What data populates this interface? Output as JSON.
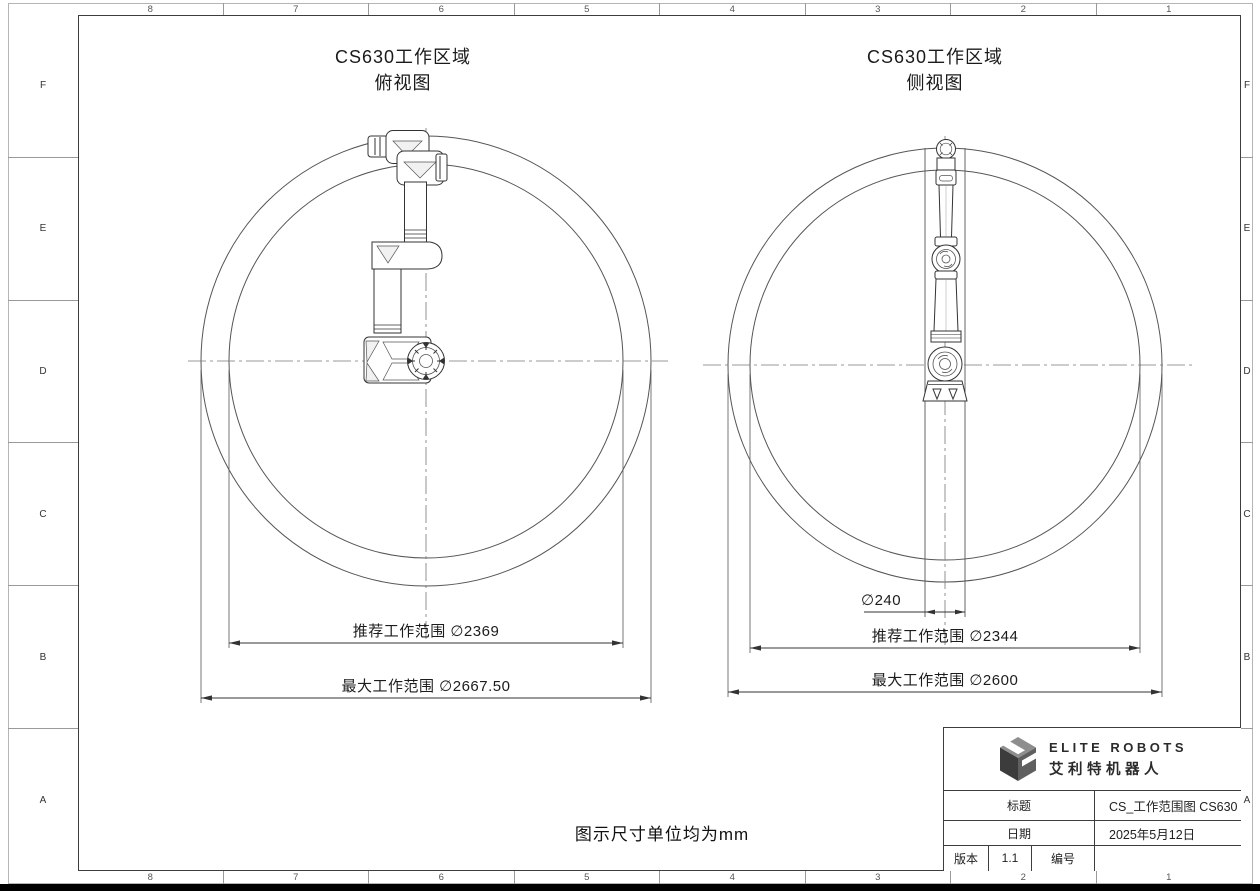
{
  "frame": {
    "top": [
      "8",
      "7",
      "6",
      "5",
      "4",
      "3",
      "2",
      "1"
    ],
    "bottom": [
      "8",
      "7",
      "6",
      "5",
      "4",
      "3",
      "2",
      "1"
    ],
    "left": [
      "F",
      "E",
      "D",
      "C",
      "B",
      "A"
    ],
    "right": [
      "F",
      "E",
      "D",
      "C",
      "B",
      "A"
    ]
  },
  "note": "图示尺寸单位均为mm",
  "top_view": {
    "title1": "CS630工作区域",
    "title2": "俯视图",
    "dim_recommended": "推荐工作范围 ∅2369",
    "dim_max": "最大工作范围 ∅2667.50"
  },
  "side_view": {
    "title1": "CS630工作区域",
    "title2": "侧视图",
    "dim_base": "∅240",
    "dim_recommended": "推荐工作范围 ∅2344",
    "dim_max": "最大工作范围 ∅2600"
  },
  "title_block": {
    "brand_en": "ELITE ROBOTS",
    "brand_zh": "艾利特机器人",
    "title_label": "标题",
    "title_value": "CS_工作范围图 CS630",
    "date_label": "日期",
    "date_value": "2025年5月12日",
    "version_label": "版本",
    "version_value": "1.1",
    "number_label": "编号",
    "number_value": "",
    "logo_dark": "#3c3c3c",
    "logo_mid": "#8e8e8e",
    "logo_side": "#5f5f5f"
  }
}
